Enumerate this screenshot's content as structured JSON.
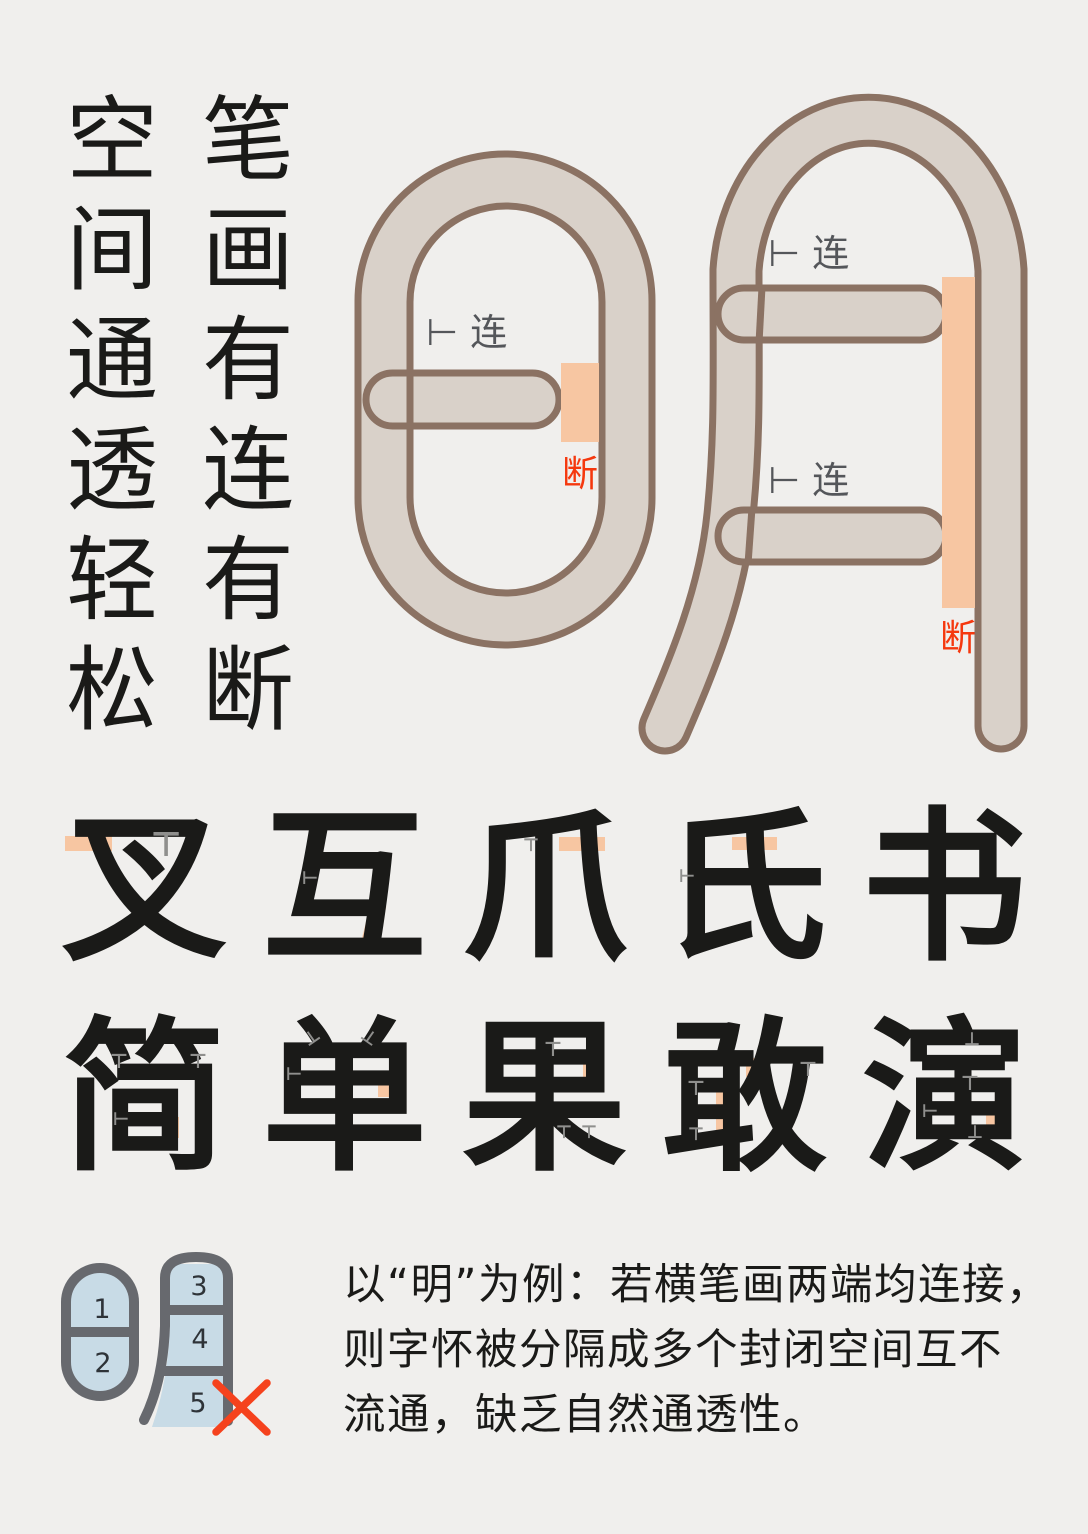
{
  "palette": {
    "background": "#f0efed",
    "ink": "#1a1a18",
    "stroke_beige": "#d9d1c9",
    "stroke_brown": "#8b7263",
    "break_orange": "#f7c6a2",
    "duan_red": "#f5380e",
    "label_gray": "#54565a",
    "mark_gray": "#8f8f8d",
    "diagram_gray": "#67696e",
    "diagram_blue": "#c8dbe6",
    "digit_color": "#2e3338",
    "x_red": "#f5421d"
  },
  "header_columns": [
    {
      "id": "strokes-slogan",
      "text": "笔画有连有断",
      "x": 200
    },
    {
      "id": "space-slogan",
      "text": "空间通透轻松",
      "x": 64
    }
  ],
  "ming_diagram": {
    "join_label": "⊢连",
    "break_label": "断"
  },
  "display_rows": [
    "叉互爪氏书",
    "简单果敢演"
  ],
  "break_marks": [
    {
      "x": 65,
      "y": 836,
      "w": 47,
      "h": 15,
      "r": 0
    },
    {
      "x": 366,
      "y": 904,
      "w": 16,
      "h": 38,
      "r": 14
    },
    {
      "x": 559,
      "y": 837,
      "w": 46,
      "h": 14,
      "r": 0
    },
    {
      "x": 732,
      "y": 837,
      "w": 45,
      "h": 13,
      "r": 0
    },
    {
      "x": 952,
      "y": 878,
      "w": 48,
      "h": 13,
      "r": 0
    },
    {
      "x": 163,
      "y": 1117,
      "w": 16,
      "h": 21,
      "r": 0
    },
    {
      "x": 378,
      "y": 1077,
      "w": 26,
      "h": 20,
      "r": 0
    },
    {
      "x": 583,
      "y": 1059,
      "w": 17,
      "h": 21,
      "r": 0
    },
    {
      "x": 716,
      "y": 1088,
      "w": 11,
      "h": 45,
      "r": 0
    },
    {
      "x": 746,
      "y": 1058,
      "w": 16,
      "h": 19,
      "r": 0
    },
    {
      "x": 986,
      "y": 1108,
      "w": 12,
      "h": 22,
      "r": 0
    }
  ],
  "join_marks": [
    {
      "g": "⊤",
      "x": 166,
      "y": 845,
      "s": 34,
      "r": 0
    },
    {
      "g": "⊢",
      "x": 310,
      "y": 879,
      "s": 18,
      "r": 0
    },
    {
      "g": "⊤",
      "x": 531,
      "y": 846,
      "s": 18,
      "r": 0
    },
    {
      "g": "⊢",
      "x": 687,
      "y": 877,
      "s": 18,
      "r": 0
    },
    {
      "g": "⊤",
      "x": 119,
      "y": 1061,
      "s": 20,
      "r": 0
    },
    {
      "g": "⊤",
      "x": 198,
      "y": 1061,
      "s": 20,
      "r": 0
    },
    {
      "g": "⊢",
      "x": 121,
      "y": 1120,
      "s": 18,
      "r": 0
    },
    {
      "g": "⊥",
      "x": 312,
      "y": 1038,
      "s": 18,
      "r": -35
    },
    {
      "g": "⊥",
      "x": 369,
      "y": 1038,
      "s": 18,
      "r": 35
    },
    {
      "g": "⊢",
      "x": 294,
      "y": 1075,
      "s": 18,
      "r": 0
    },
    {
      "g": "⊤",
      "x": 553,
      "y": 1049,
      "s": 20,
      "r": 0
    },
    {
      "g": "⊤",
      "x": 564,
      "y": 1133,
      "s": 18,
      "r": 0
    },
    {
      "g": "⊤",
      "x": 589,
      "y": 1133,
      "s": 18,
      "r": 0
    },
    {
      "g": "⊤",
      "x": 696,
      "y": 1088,
      "s": 20,
      "r": 0
    },
    {
      "g": "⊤",
      "x": 808,
      "y": 1069,
      "s": 20,
      "r": 0
    },
    {
      "g": "⊤",
      "x": 696,
      "y": 1135,
      "s": 18,
      "r": 0
    },
    {
      "g": "⊥",
      "x": 972,
      "y": 1040,
      "s": 18,
      "r": 0
    },
    {
      "g": "⊤",
      "x": 970,
      "y": 1083,
      "s": 20,
      "r": 0
    },
    {
      "g": "⊢",
      "x": 930,
      "y": 1112,
      "s": 18,
      "r": 0
    },
    {
      "g": "⊥",
      "x": 975,
      "y": 1133,
      "s": 18,
      "r": 0
    }
  ],
  "legend_numbers": [
    "1",
    "2",
    "3",
    "4",
    "5"
  ],
  "paragraph": {
    "lines": [
      "以“明”为例：若横笔画两端均连接，",
      "则字怀被分隔成多个封闭空间互不",
      "流通，缺乏自然通透性。"
    ]
  }
}
